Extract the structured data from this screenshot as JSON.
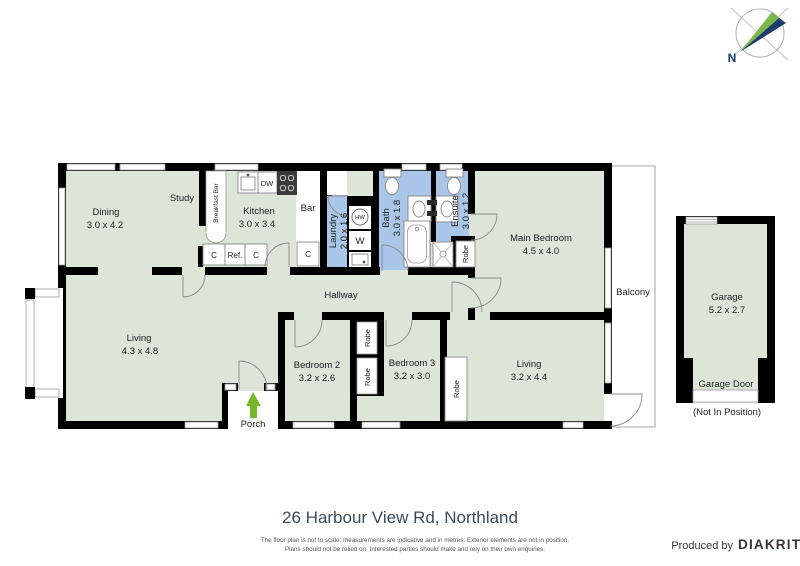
{
  "compass": {
    "north_label": "N"
  },
  "rooms": {
    "dining": {
      "name": "Dining",
      "dims": "3.0 x 4.2"
    },
    "study": {
      "name": "Study"
    },
    "kitchen": {
      "name": "Kitchen",
      "dims": "3.0 x 3.4"
    },
    "bar": {
      "name": "Bar"
    },
    "laundry": {
      "name": "Laundry",
      "dims": "2.0 x 1.6"
    },
    "bath": {
      "name": "Bath",
      "dims": "3.0 x 1.8"
    },
    "ensuite": {
      "name": "Ensuite",
      "dims": "3.0 x 1.2"
    },
    "main_bedroom": {
      "name": "Main Bedroom",
      "dims": "4.5 x 4.0"
    },
    "balcony": {
      "name": "Balcony"
    },
    "hallway": {
      "name": "Hallway"
    },
    "living": {
      "name": "Living",
      "dims": "4.3 x 4.8"
    },
    "bedroom2": {
      "name": "Bedroom 2",
      "dims": "3.2 x 2.6"
    },
    "bedroom3": {
      "name": "Bedroom 3",
      "dims": "3.2 x 3.0"
    },
    "living2": {
      "name": "Living",
      "dims": "3.2 x 4.4"
    },
    "porch": {
      "name": "Porch"
    },
    "garage": {
      "name": "Garage",
      "dims": "5.2 x 2.7"
    }
  },
  "fixtures": {
    "breakfast_bar": "Breakfast Bar",
    "dishwasher": "DW",
    "hot_water": "HW",
    "washer": "W",
    "cupboard": "C",
    "fridge": "Ref.",
    "robe": "Robe",
    "garage_door_label": "Garage Door",
    "garage_door_note": "(Not In Position)"
  },
  "footer": {
    "title": "26 Harbour View Rd, Northland",
    "disclaimer_line1": "The floor plan is not to scale; measurements are indicative and in metres. Exterior elements are not in position.",
    "disclaimer_line2": "Plans should not be relied on. Interested parties should make and rely on their own enquiries.",
    "produced_by": "Produced by",
    "brand": "DIAKRIT"
  },
  "colors": {
    "floor_fill": "#dce5d8",
    "wet_area_fill": "#a9c6e8",
    "wall": "#000000",
    "entry_arrow_green": "#76b82a",
    "compass_green": "#7ab648",
    "compass_navy": "#1d3c6b",
    "outline_gray": "#999999",
    "title_text": "#3d4b58",
    "brand_text": "#3a3434"
  }
}
